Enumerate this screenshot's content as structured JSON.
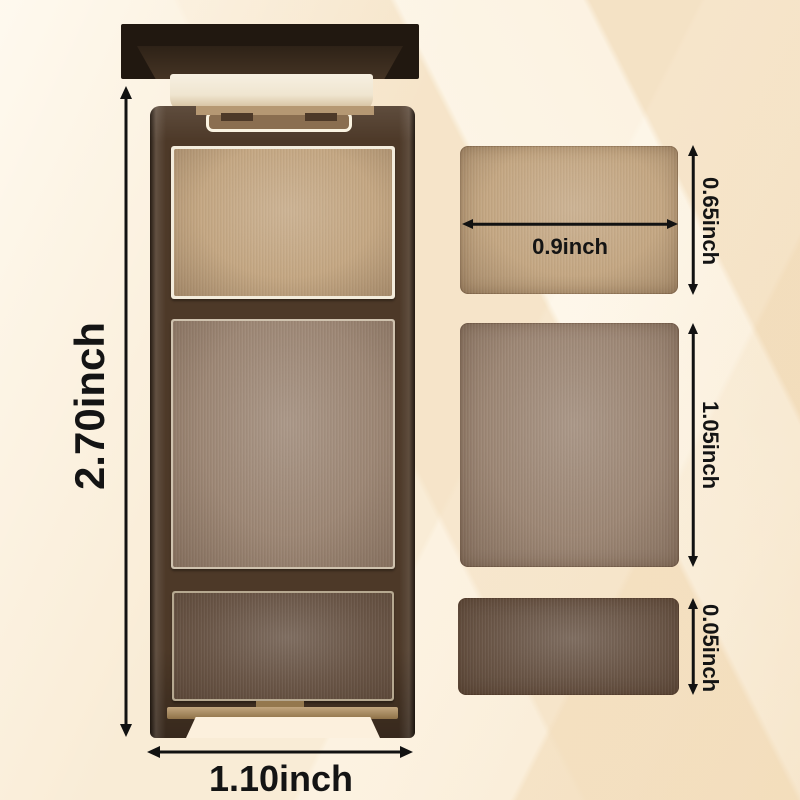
{
  "product": {
    "name": "three-shade eyebrow powder palette with flip-up mirror lid",
    "case": {
      "height_label": "2.70inch",
      "width_label": "1.10inch",
      "body_color": "#4d3928",
      "lid_color": "#211810"
    },
    "pans": [
      {
        "shade": "light-tan",
        "color": "#c4a783",
        "width_label": "0.9inch",
        "height_label": "0.65inch"
      },
      {
        "shade": "medium-taupe",
        "color": "#9d8775",
        "height_label": "1.05inch"
      },
      {
        "shade": "dark-brown",
        "color": "#6a5647",
        "height_label": "0.05inch"
      }
    ],
    "background": {
      "base": "#f9ecd6",
      "band_light": "#fdf6e8",
      "band_dark": "#f3e0c2"
    }
  }
}
